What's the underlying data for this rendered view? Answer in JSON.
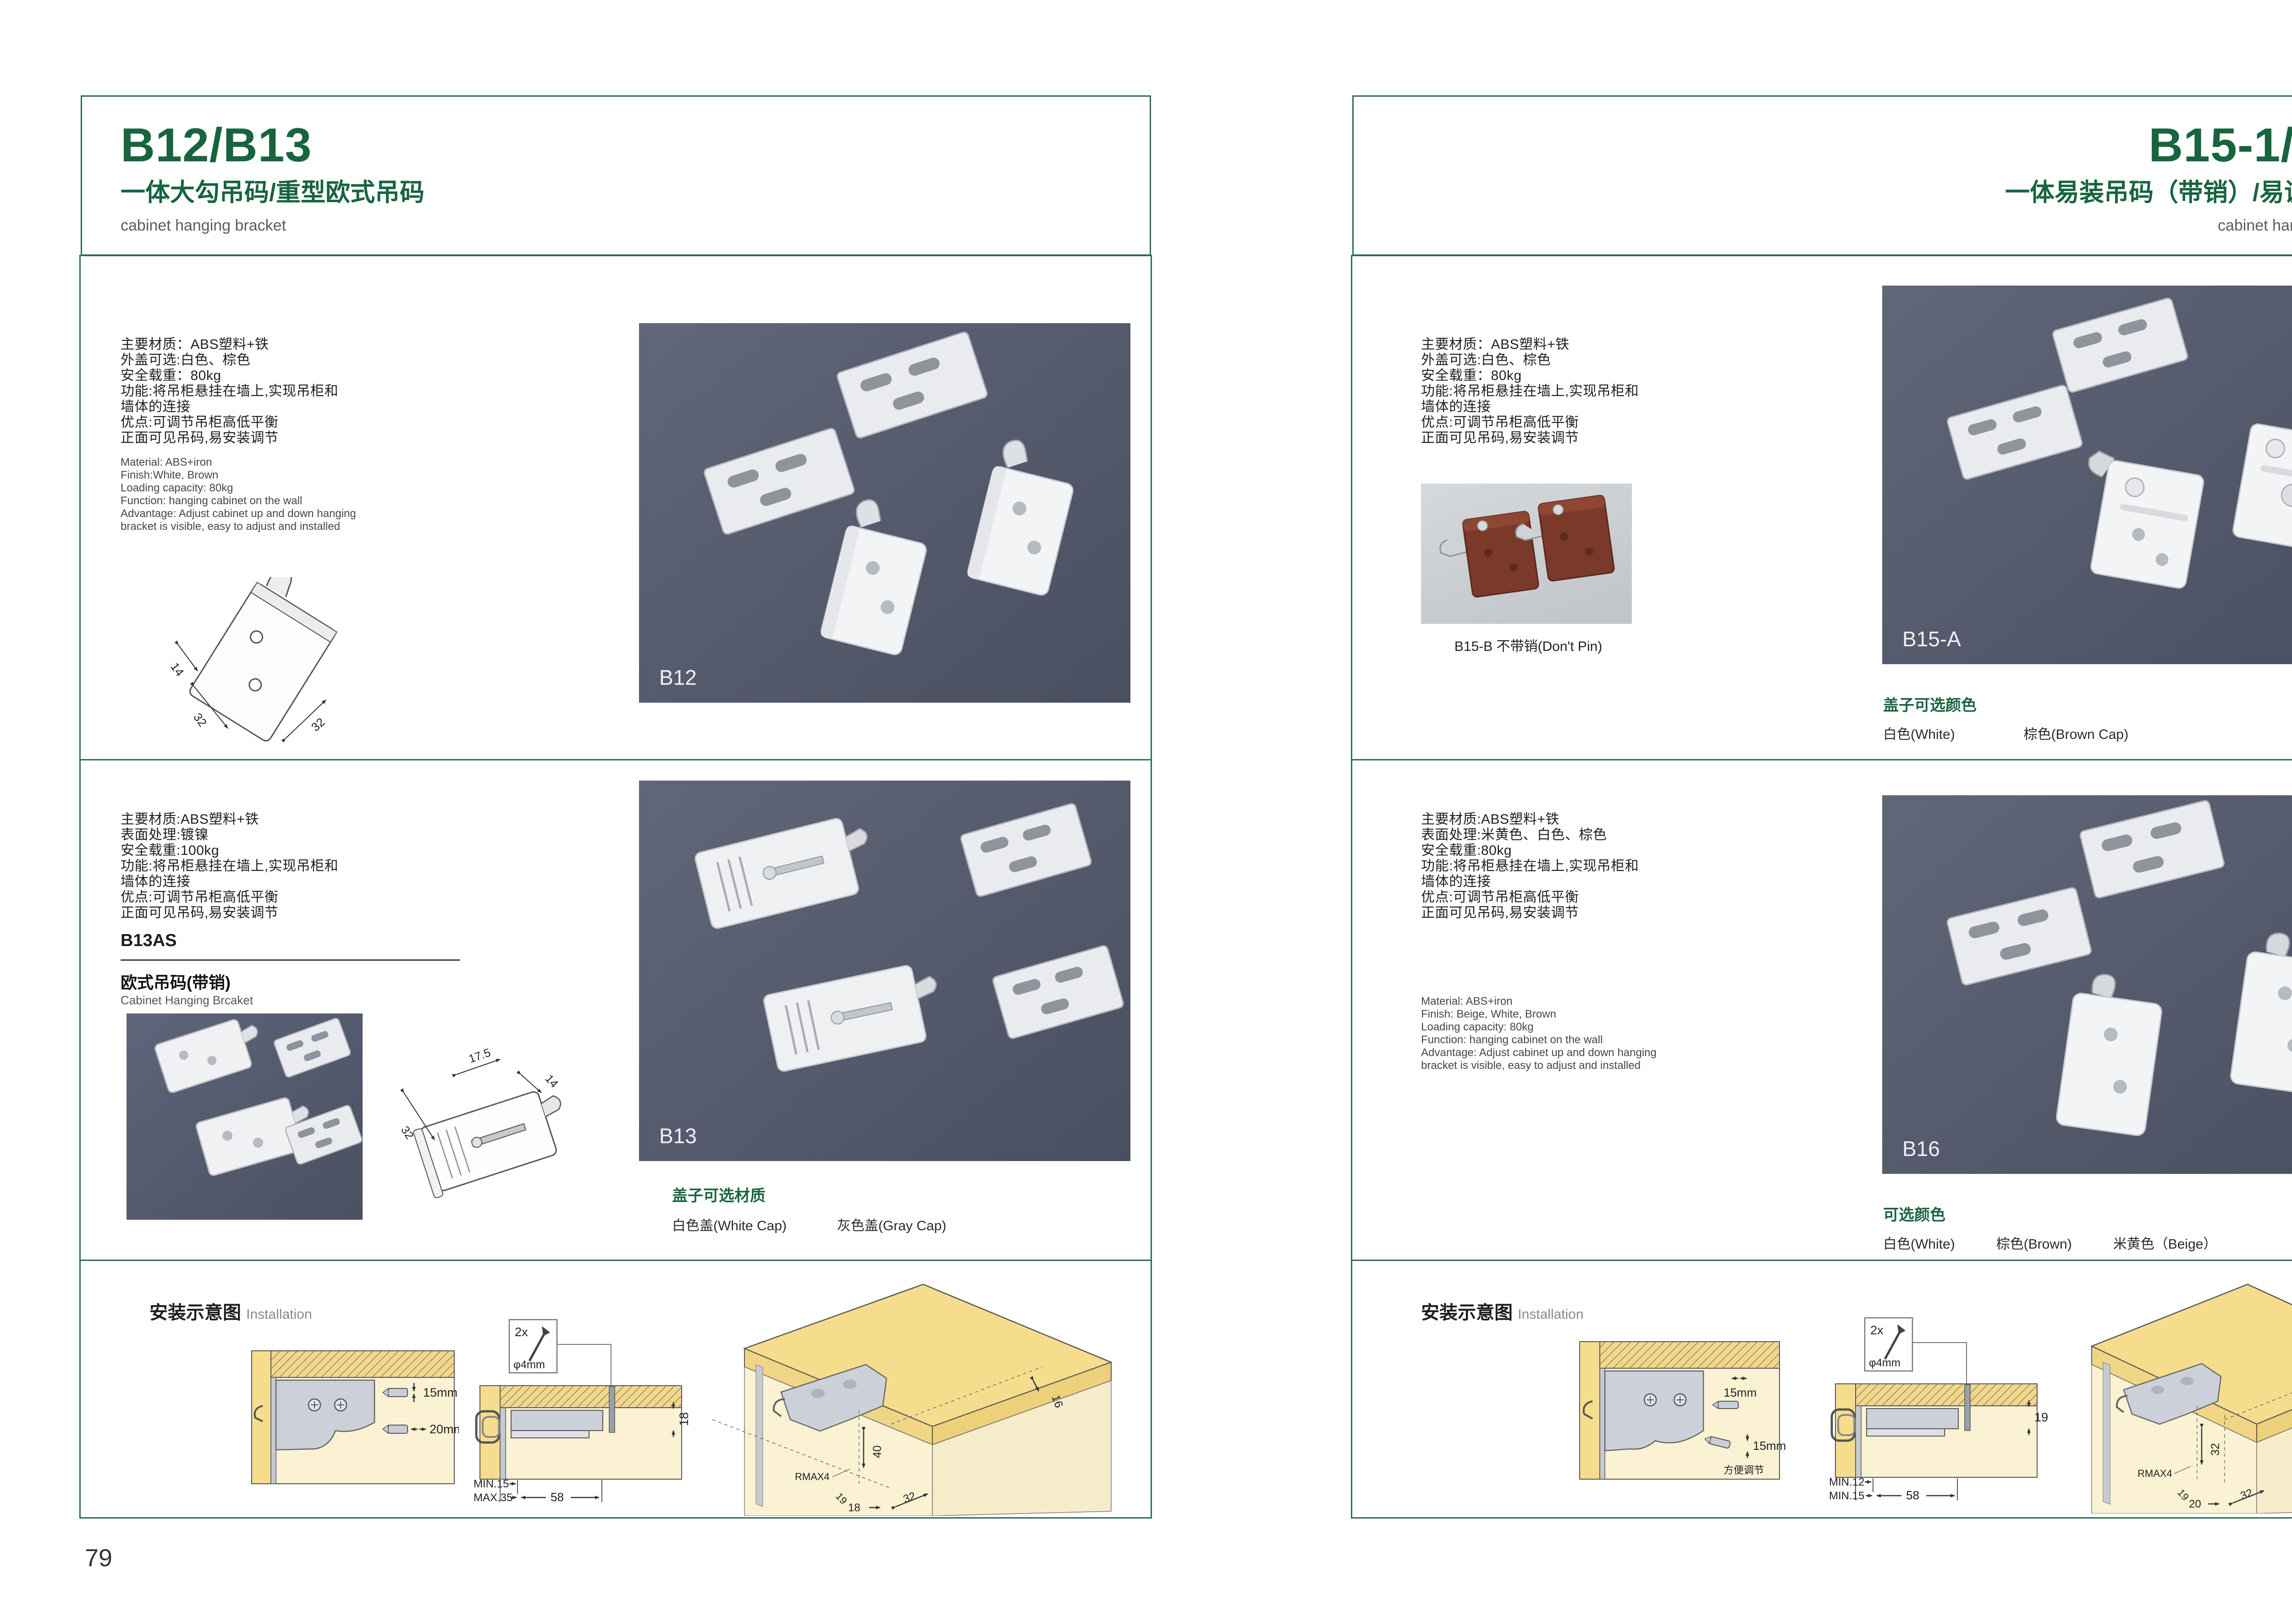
{
  "colors": {
    "accent": "#17643f",
    "border": "#2f6a55",
    "photo_bg": "#565c6e",
    "thumb_bg": "#c9cdd0"
  },
  "page_left": {
    "page_number": "79",
    "header": {
      "title": "B12/B13",
      "subtitle": "一体大勾吊码/重型欧式吊码",
      "tagline": "cabinet hanging bracket"
    },
    "s1": {
      "specs_cn": [
        "主要材质：ABS塑料+铁",
        "外盖可选:白色、棕色",
        "安全载重：80kg",
        "功能:将吊柜悬挂在墙上,实现吊柜和",
        "墙体的连接",
        "优点:可调节吊柜高低平衡",
        "正面可见吊码,易安装调节"
      ],
      "specs_en": [
        "Material: ABS+iron",
        "Finish:White, Brown",
        "Loading capacity: 80kg",
        "Function: hanging cabinet on the wall",
        "Advantage: Adjust cabinet up and down hanging",
        "bracket is visible, easy to adjust and installed"
      ],
      "drawing": {
        "d1": "14",
        "d2": "32",
        "d3": "32"
      },
      "photo_label": "B12"
    },
    "s2": {
      "specs_cn": [
        "主要材质:ABS塑料+铁",
        "表面处理:镀镍",
        "安全载重:100kg",
        "功能:将吊柜悬挂在墙上,实现吊柜和",
        "墙体的连接",
        "优点:可调节吊柜高低平衡",
        "正面可见吊码,易安装调节"
      ],
      "model": "B13AS",
      "model_cn": "欧式吊码(带销)",
      "model_en": "Cabinet Hanging Brcaket",
      "drawing": {
        "d1": "32",
        "d2": "17.5",
        "d3": "14"
      },
      "photo_label": "B13",
      "cap_title": "盖子可选材质",
      "cap_options": [
        "白色盖(White Cap)",
        "灰色盖(Gray Cap)"
      ]
    },
    "install": {
      "title": "安装示意图",
      "title_en": "Installation",
      "d1": {
        "dim1": "15mm",
        "dim2": "20mm"
      },
      "d2": {
        "count": "2x",
        "dia": "φ4mm",
        "side": "18",
        "l1": "MIN.15",
        "l2": "MAX.35",
        "w": "58"
      },
      "d3": {
        "a": "16",
        "b": "40",
        "c": "RMAX4",
        "d": "19",
        "e": "18",
        "f": "32"
      }
    }
  },
  "page_right": {
    "page_number": "80",
    "header": {
      "title": "B15-1/B16",
      "subtitle": "一体易装吊码（带销）/易调节吊码",
      "tagline": "cabinet hanging bracket"
    },
    "s1": {
      "specs_cn": [
        "主要材质：ABS塑料+铁",
        "外盖可选:白色、棕色",
        "安全载重：80kg",
        "功能:将吊柜悬挂在墙上,实现吊柜和",
        "墙体的连接",
        "优点:可调节吊柜高低平衡",
        "正面可见吊码,易安装调节"
      ],
      "thumb_caption": "B15-B 不带销(Don't Pin)",
      "photo_label": "B15-A",
      "cap_title": "盖子可选颜色",
      "cap_options": [
        "白色(White)",
        "棕色(Brown Cap)"
      ]
    },
    "s2": {
      "specs_cn": [
        "主要材质:ABS塑料+铁",
        "表面处理:米黄色、白色、棕色",
        "安全载重:80kg",
        "功能:将吊柜悬挂在墙上,实现吊柜和",
        "墙体的连接",
        "优点:可调节吊柜高低平衡",
        "正面可见吊码,易安装调节"
      ],
      "specs_en": [
        "Material: ABS+iron",
        "Finish: Beige, White, Brown",
        "Loading capacity: 80kg",
        "Function: hanging cabinet on the wall",
        "Advantage: Adjust cabinet up and down hanging",
        "bracket is visible, easy to adjust and installed"
      ],
      "photo_label": "B16",
      "cap_title": "可选颜色",
      "cap_options": [
        "白色(White)",
        "棕色(Brown)",
        "米黄色（Beige）"
      ]
    },
    "install": {
      "title": "安装示意图",
      "title_en": "Installation",
      "d1": {
        "dim1": "15mm",
        "dim2": "15mm",
        "note": "方便调节"
      },
      "d2": {
        "count": "2x",
        "dia": "φ4mm",
        "side": "19",
        "l1": "MIN.12",
        "l2": "MIN.15",
        "w": "58"
      },
      "d3": {
        "a": "30",
        "b": "32",
        "c": "RMAX4",
        "d": "19",
        "e": "20",
        "f": "32"
      }
    }
  }
}
